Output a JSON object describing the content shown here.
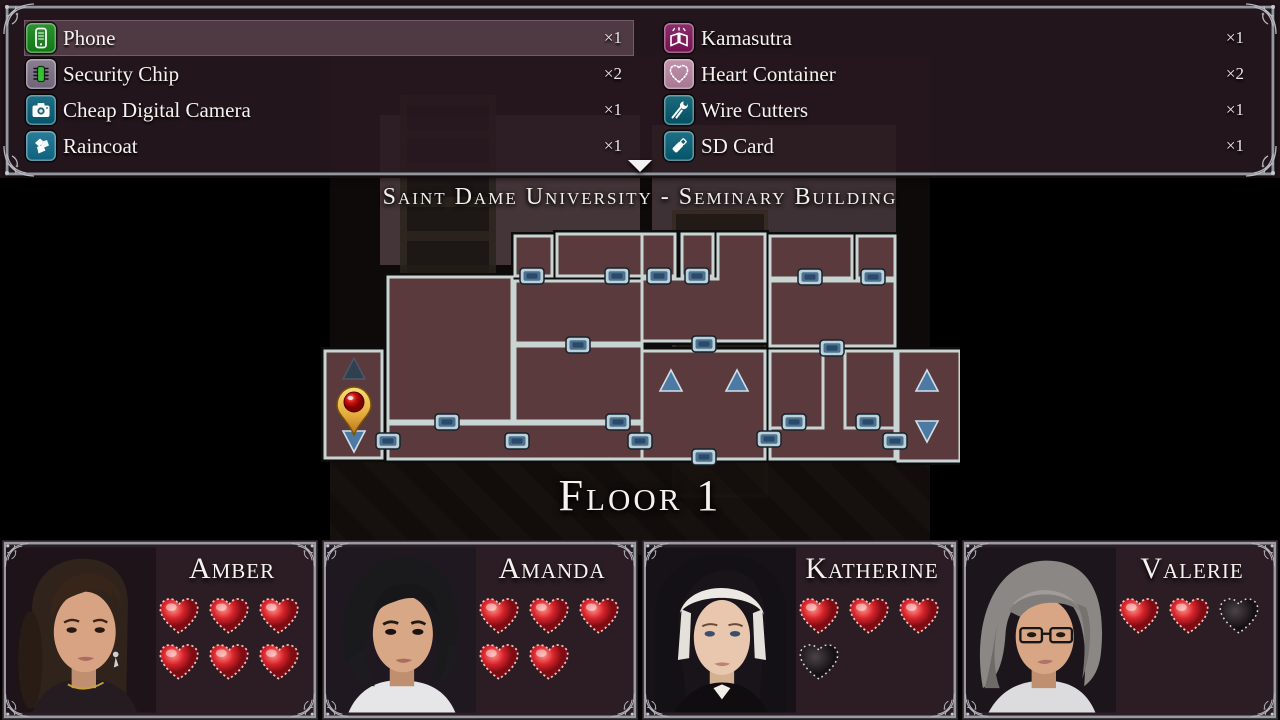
{
  "inventory": {
    "columns": [
      {
        "items": [
          {
            "label": "Phone",
            "count": "×1",
            "icon": "phone-icon",
            "icon_color": "#2d9230",
            "highlighted": true
          },
          {
            "label": "Security Chip",
            "count": "×2",
            "icon": "security-chip-icon",
            "icon_color": "#8a7f93",
            "highlighted": false
          },
          {
            "label": "Cheap Digital Camera",
            "count": "×1",
            "icon": "camera-icon",
            "icon_color": "#1f6f86",
            "highlighted": false
          },
          {
            "label": "Raincoat",
            "count": "×1",
            "icon": "raincoat-icon",
            "icon_color": "#2a7d99",
            "highlighted": false
          }
        ]
      },
      {
        "items": [
          {
            "label": "Kamasutra",
            "count": "×1",
            "icon": "kamasutra-book-icon",
            "icon_color": "#8e2d6b",
            "highlighted": false
          },
          {
            "label": "Heart Container",
            "count": "×2",
            "icon": "heart-container-icon",
            "icon_color": "#c193ad",
            "highlighted": false
          },
          {
            "label": "Wire Cutters",
            "count": "×1",
            "icon": "wire-cutters-icon",
            "icon_color": "#1d6b7d",
            "highlighted": false
          },
          {
            "label": "SD Card",
            "count": "×1",
            "icon": "sd-card-icon",
            "icon_color": "#1f7085",
            "highlighted": false
          }
        ]
      }
    ]
  },
  "map": {
    "title": "Saint Dame University - Seminary Building",
    "floor_label": "Floor 1",
    "marker_legend": {
      "player_location": "location-pin-icon",
      "stairs_up": "stairs-up-icon",
      "stairs_down": "stairs-down-icon",
      "door": "door-marker"
    }
  },
  "characters": [
    {
      "name": "Amber",
      "portrait": "amber",
      "hearts_filled": 6,
      "hearts_total": 6
    },
    {
      "name": "Amanda",
      "portrait": "amanda",
      "hearts_filled": 5,
      "hearts_total": 5
    },
    {
      "name": "Katherine",
      "portrait": "katherine",
      "hearts_filled": 3,
      "hearts_total": 4
    },
    {
      "name": "Valerie",
      "portrait": "valerie",
      "hearts_filled": 2,
      "hearts_total": 3
    }
  ],
  "colors": {
    "panel_bg": "#291920",
    "row_highlight": "#a88294",
    "room_fill": "#5a3a3c",
    "room_border": "#c9d5d3",
    "door_fill": "#4a7092",
    "stair_fill": "#4d7aa2",
    "heart_red": "#c81a22",
    "heart_empty": "#241d20",
    "frame_silver": "#9a9aa2",
    "pin_gold": "#e8b83a",
    "pin_red": "#c00808"
  }
}
